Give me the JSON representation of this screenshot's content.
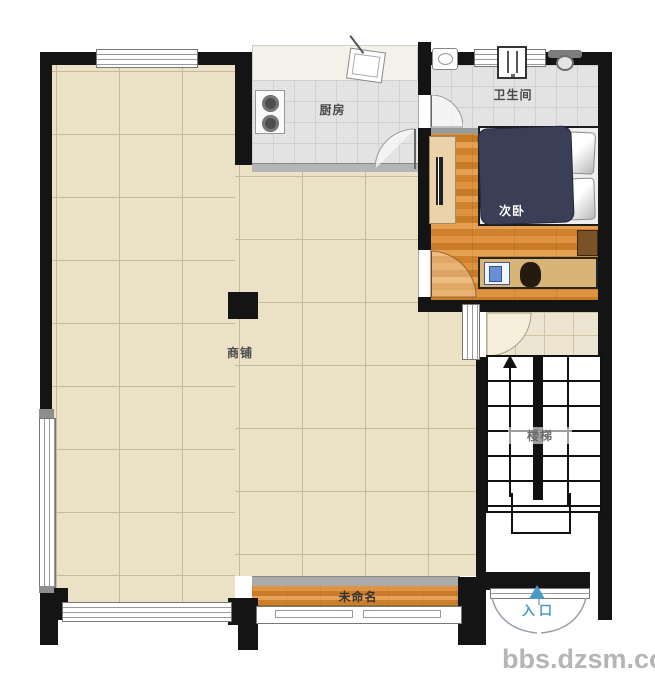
{
  "rooms": {
    "shop": {
      "label": "商铺"
    },
    "kitchen": {
      "label": "厨房"
    },
    "bathroom": {
      "label": "卫生间"
    },
    "bedroom": {
      "label": "次卧"
    },
    "stairs": {
      "label": "楼梯"
    },
    "unnamed": {
      "label": "未命名"
    },
    "entrance": {
      "label": "入口"
    }
  },
  "furniture_icons": [
    "stove-icon",
    "kitchen-sink-icon",
    "bath-sink-icon",
    "shower-heater-icon",
    "toilet-icon",
    "bed",
    "pillow",
    "wardrobe",
    "nightstand",
    "desk",
    "computer-icon",
    "chair",
    "column",
    "stairs-up-arrow-icon",
    "entrance-arrow-icon"
  ],
  "watermark": {
    "text": "bbs.dzsm.com"
  },
  "colors": {
    "wall": "#141414",
    "shop_floor": "#eae1c6",
    "tile_floor": "#e3e3e3",
    "wood_floor": "#d0872f",
    "bed": "#3a3e56",
    "entrance_accent": "#4a9ac8",
    "watermark": "#b5b5b5"
  }
}
